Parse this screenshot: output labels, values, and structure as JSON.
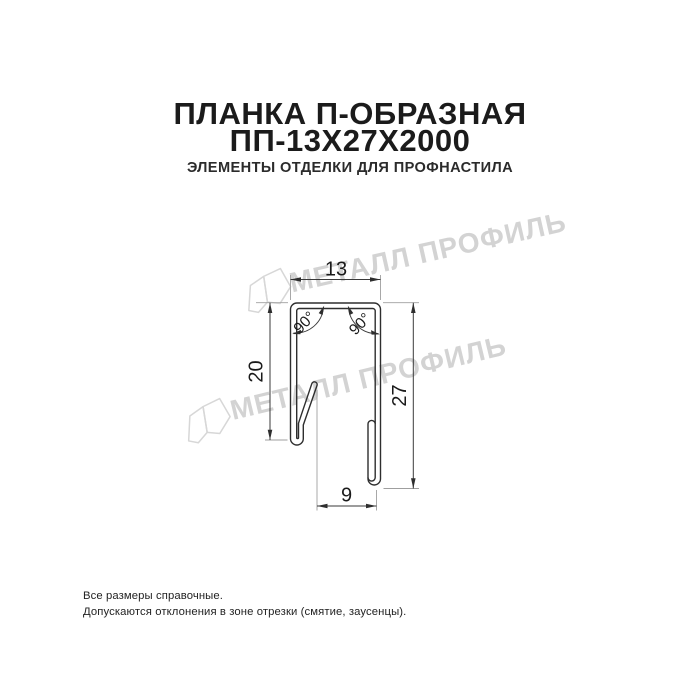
{
  "header": {
    "title_line1": "ПЛАНКА П-ОБРАЗНАЯ",
    "title_line2": "ПП-13Х27Х2000",
    "subtitle": "ЭЛЕМЕНТЫ ОТДЕЛКИ ДЛЯ ПРОФНАСТИЛА"
  },
  "drawing": {
    "type": "technical-cross-section",
    "dimensions": {
      "top_width": "13",
      "left_height": "20",
      "right_height": "27",
      "bottom_width": "9",
      "angle_left": "90°",
      "angle_right": "90°"
    },
    "watermark": {
      "text": "МЕТАЛЛ ПРОФИЛЬ",
      "color": "#d3d3d3"
    },
    "stroke_color": "#2e2e2e"
  },
  "footer": {
    "line1": "Все размеры справочные.",
    "line2": "Допускаются отклонения в зоне отрезки (смятие, заусенцы)."
  }
}
